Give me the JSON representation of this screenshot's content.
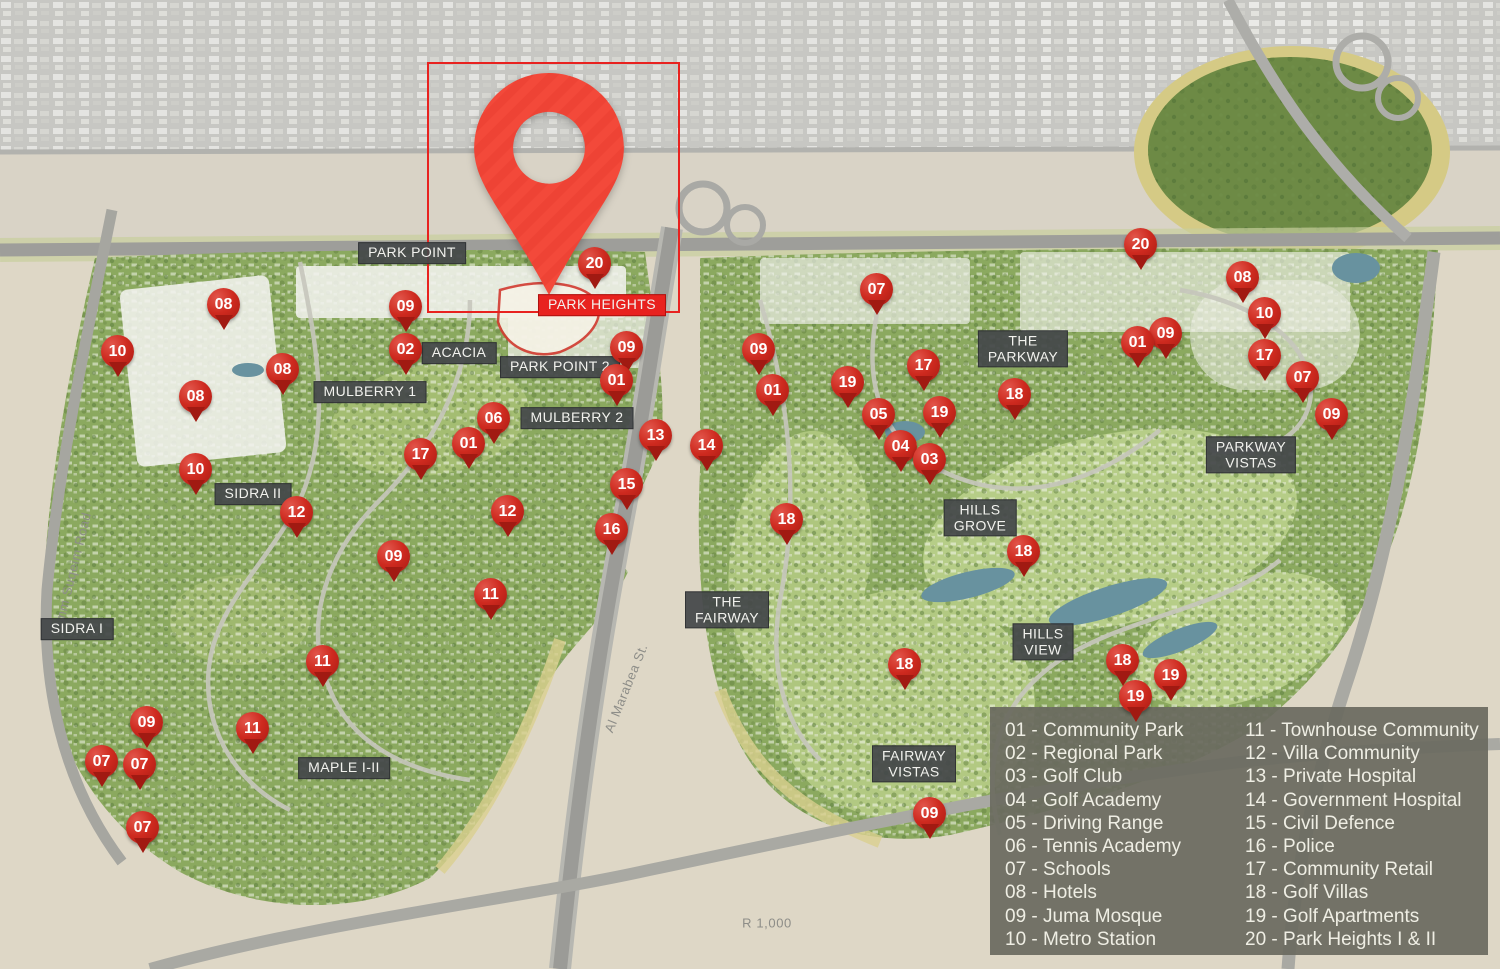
{
  "colors": {
    "marker_red": "#ce2a1f",
    "marker_dark": "#a11a12",
    "pin_red": "#f3493a",
    "pin_stripe": "#e93d2f",
    "highlight_red": "#e8221f",
    "area_label_bg": "#444749",
    "legend_bg": "#6a6a60",
    "legend_text": "#efeee4",
    "map_green": "#8ba95f",
    "desert": "#ded7c6",
    "water": "#68929f"
  },
  "map": {
    "width": 1500,
    "height": 969,
    "pin": {
      "tip_x": 549,
      "tip_y": 295,
      "width": 150,
      "height": 222
    },
    "highlight_box": {
      "x": 427,
      "y": 62,
      "w": 249,
      "h": 247
    },
    "area_labels": [
      {
        "id": "park-point",
        "lines": [
          "PARK POINT"
        ],
        "x": 412,
        "y": 253,
        "style": "dark"
      },
      {
        "id": "park-heights",
        "lines": [
          "PARK HEIGHTS"
        ],
        "x": 602,
        "y": 305,
        "style": "red"
      },
      {
        "id": "acacia",
        "lines": [
          "ACACIA"
        ],
        "x": 459,
        "y": 353,
        "style": "dark"
      },
      {
        "id": "park-point-2",
        "lines": [
          "PARK POINT 2"
        ],
        "x": 560,
        "y": 367,
        "style": "dark"
      },
      {
        "id": "mulberry-1",
        "lines": [
          "MULBERRY 1"
        ],
        "x": 370,
        "y": 392,
        "style": "dark"
      },
      {
        "id": "mulberry-2",
        "lines": [
          "MULBERRY 2"
        ],
        "x": 577,
        "y": 418,
        "style": "dark"
      },
      {
        "id": "sidra-ii",
        "lines": [
          "SIDRA II"
        ],
        "x": 253,
        "y": 494,
        "style": "dark"
      },
      {
        "id": "sidra-i",
        "lines": [
          "SIDRA I"
        ],
        "x": 77,
        "y": 629,
        "style": "dark"
      },
      {
        "id": "maple-i-ii",
        "lines": [
          "MAPLE I-II"
        ],
        "x": 344,
        "y": 768,
        "style": "dark"
      },
      {
        "id": "the-parkway",
        "lines": [
          "THE",
          "PARKWAY"
        ],
        "x": 1023,
        "y": 349,
        "style": "dark"
      },
      {
        "id": "parkway-vistas",
        "lines": [
          "PARKWAY",
          "VISTAS"
        ],
        "x": 1251,
        "y": 455,
        "style": "dark"
      },
      {
        "id": "hills-grove",
        "lines": [
          "HILLS",
          "GROVE"
        ],
        "x": 980,
        "y": 518,
        "style": "dark"
      },
      {
        "id": "hills-view",
        "lines": [
          "HILLS",
          "VIEW"
        ],
        "x": 1043,
        "y": 642,
        "style": "dark"
      },
      {
        "id": "the-fairway",
        "lines": [
          "THE",
          "FAIRWAY"
        ],
        "x": 727,
        "y": 610,
        "style": "dark"
      },
      {
        "id": "fairway-vistas",
        "lines": [
          "FAIRWAY",
          "VISTAS"
        ],
        "x": 914,
        "y": 764,
        "style": "dark"
      }
    ],
    "road_labels": [
      {
        "text": "Umm Suqeim Road",
        "x": 72,
        "y": 572,
        "angle": -76
      },
      {
        "text": "Al Marabea St.",
        "x": 626,
        "y": 688,
        "angle": -68
      },
      {
        "text": "R 1,000",
        "x": 767,
        "y": 923,
        "angle": 0
      }
    ],
    "markers": [
      {
        "label": "08",
        "x": 224,
        "y": 313
      },
      {
        "label": "10",
        "x": 118,
        "y": 360
      },
      {
        "label": "08",
        "x": 283,
        "y": 378
      },
      {
        "label": "08",
        "x": 196,
        "y": 405
      },
      {
        "label": "09",
        "x": 406,
        "y": 315
      },
      {
        "label": "02",
        "x": 406,
        "y": 358
      },
      {
        "label": "10",
        "x": 196,
        "y": 478
      },
      {
        "label": "12",
        "x": 297,
        "y": 521
      },
      {
        "label": "17",
        "x": 421,
        "y": 463
      },
      {
        "label": "01",
        "x": 469,
        "y": 452
      },
      {
        "label": "06",
        "x": 494,
        "y": 427
      },
      {
        "label": "12",
        "x": 508,
        "y": 520
      },
      {
        "label": "09",
        "x": 394,
        "y": 565
      },
      {
        "label": "11",
        "x": 491,
        "y": 603
      },
      {
        "label": "11",
        "x": 323,
        "y": 670
      },
      {
        "label": "11",
        "x": 253,
        "y": 737
      },
      {
        "label": "09",
        "x": 147,
        "y": 731
      },
      {
        "label": "07",
        "x": 102,
        "y": 770
      },
      {
        "label": "07",
        "x": 140,
        "y": 773
      },
      {
        "label": "07",
        "x": 143,
        "y": 836
      },
      {
        "label": "20",
        "x": 595,
        "y": 272
      },
      {
        "label": "09",
        "x": 627,
        "y": 356
      },
      {
        "label": "01",
        "x": 617,
        "y": 389
      },
      {
        "label": "13",
        "x": 656,
        "y": 444
      },
      {
        "label": "14",
        "x": 707,
        "y": 454
      },
      {
        "label": "15",
        "x": 627,
        "y": 493
      },
      {
        "label": "16",
        "x": 612,
        "y": 538
      },
      {
        "label": "09",
        "x": 759,
        "y": 358
      },
      {
        "label": "01",
        "x": 773,
        "y": 399
      },
      {
        "label": "07",
        "x": 877,
        "y": 298
      },
      {
        "label": "20",
        "x": 1141,
        "y": 253
      },
      {
        "label": "17",
        "x": 924,
        "y": 374
      },
      {
        "label": "19",
        "x": 848,
        "y": 391
      },
      {
        "label": "05",
        "x": 879,
        "y": 423
      },
      {
        "label": "19",
        "x": 940,
        "y": 421
      },
      {
        "label": "04",
        "x": 901,
        "y": 455
      },
      {
        "label": "03",
        "x": 930,
        "y": 468
      },
      {
        "label": "18",
        "x": 1015,
        "y": 403
      },
      {
        "label": "01",
        "x": 1138,
        "y": 351
      },
      {
        "label": "09",
        "x": 1166,
        "y": 342
      },
      {
        "label": "08",
        "x": 1243,
        "y": 286
      },
      {
        "label": "10",
        "x": 1265,
        "y": 322
      },
      {
        "label": "17",
        "x": 1265,
        "y": 364
      },
      {
        "label": "07",
        "x": 1303,
        "y": 386
      },
      {
        "label": "09",
        "x": 1332,
        "y": 423
      },
      {
        "label": "18",
        "x": 787,
        "y": 528
      },
      {
        "label": "18",
        "x": 1024,
        "y": 560
      },
      {
        "label": "18",
        "x": 905,
        "y": 673
      },
      {
        "label": "18",
        "x": 1123,
        "y": 669
      },
      {
        "label": "19",
        "x": 1171,
        "y": 684
      },
      {
        "label": "19",
        "x": 1136,
        "y": 705
      },
      {
        "label": "09",
        "x": 930,
        "y": 822
      }
    ]
  },
  "legend": {
    "box": {
      "x": 990,
      "y": 707,
      "w": 498,
      "h": 248
    },
    "separator": " - ",
    "columns": [
      {
        "x_offset": 15,
        "items": [
          {
            "num": "01",
            "name": "Community Park"
          },
          {
            "num": "02",
            "name": "Regional Park"
          },
          {
            "num": "03",
            "name": "Golf Club"
          },
          {
            "num": "04",
            "name": "Golf Academy"
          },
          {
            "num": "05",
            "name": "Driving Range"
          },
          {
            "num": "06",
            "name": "Tennis Academy"
          },
          {
            "num": "07",
            "name": "Schools"
          },
          {
            "num": "08",
            "name": "Hotels"
          },
          {
            "num": "09",
            "name": "Juma Mosque"
          },
          {
            "num": "10",
            "name": "Metro Station"
          }
        ]
      },
      {
        "x_offset": 255,
        "items": [
          {
            "num": "11",
            "name": "Townhouse Community"
          },
          {
            "num": "12",
            "name": "Villa Community"
          },
          {
            "num": "13",
            "name": "Private Hospital"
          },
          {
            "num": "14",
            "name": "Government Hospital"
          },
          {
            "num": "15",
            "name": "Civil Defence"
          },
          {
            "num": "16",
            "name": "Police"
          },
          {
            "num": "17",
            "name": "Community Retail"
          },
          {
            "num": "18",
            "name": "Golf Villas"
          },
          {
            "num": "19",
            "name": "Golf Apartments"
          },
          {
            "num": "20",
            "name": "Park Heights I & II"
          }
        ]
      }
    ]
  }
}
